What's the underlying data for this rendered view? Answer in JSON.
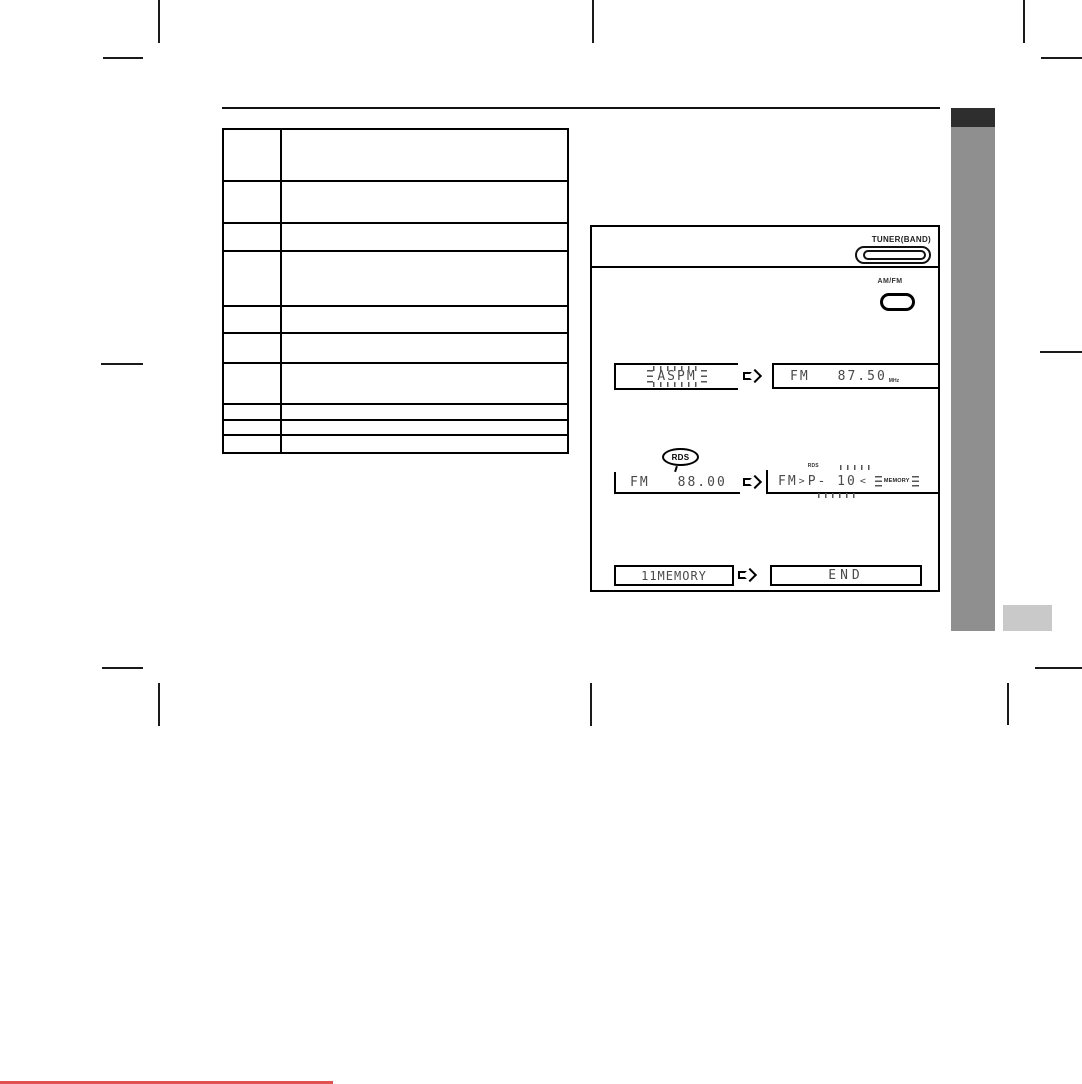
{
  "colors": {
    "ink": "#000000",
    "lcd_ink": "#4a4a4a",
    "sidebar_tab_dark": "#2e2e2e",
    "sidebar_bar_gray": "#8f8f8f",
    "corner_tab_light": "#c9c9c9",
    "footer_edge_red": "#e25252"
  },
  "table": {
    "row_count": 10,
    "column_count": 2,
    "content": ""
  },
  "tuner_panel": {
    "step1": {
      "button_label": "TUNER(BAND)"
    },
    "step2": {
      "button_label": "AM/FM"
    },
    "displays": {
      "row1": {
        "left_text": "ASPM",
        "right_band": "FM",
        "right_value": "87.50",
        "right_unit": "MHz"
      },
      "row2": {
        "balloon": "RDS",
        "indicator": "RDS",
        "left_band": "FM",
        "left_value": "88.00",
        "right_band": "FM",
        "flash_open": ">",
        "right_small_label": "RDS",
        "right_preset": "P- 10",
        "flash_close": "<",
        "memory_badge": "MEMORY"
      },
      "row3": {
        "left_text": "11MEMORY",
        "right_text": "END"
      }
    }
  },
  "icons": {
    "arrow": "right-block-arrow",
    "tuner_band_button": "double-outline-pill",
    "amfm_button": "bold-outline-pill"
  }
}
